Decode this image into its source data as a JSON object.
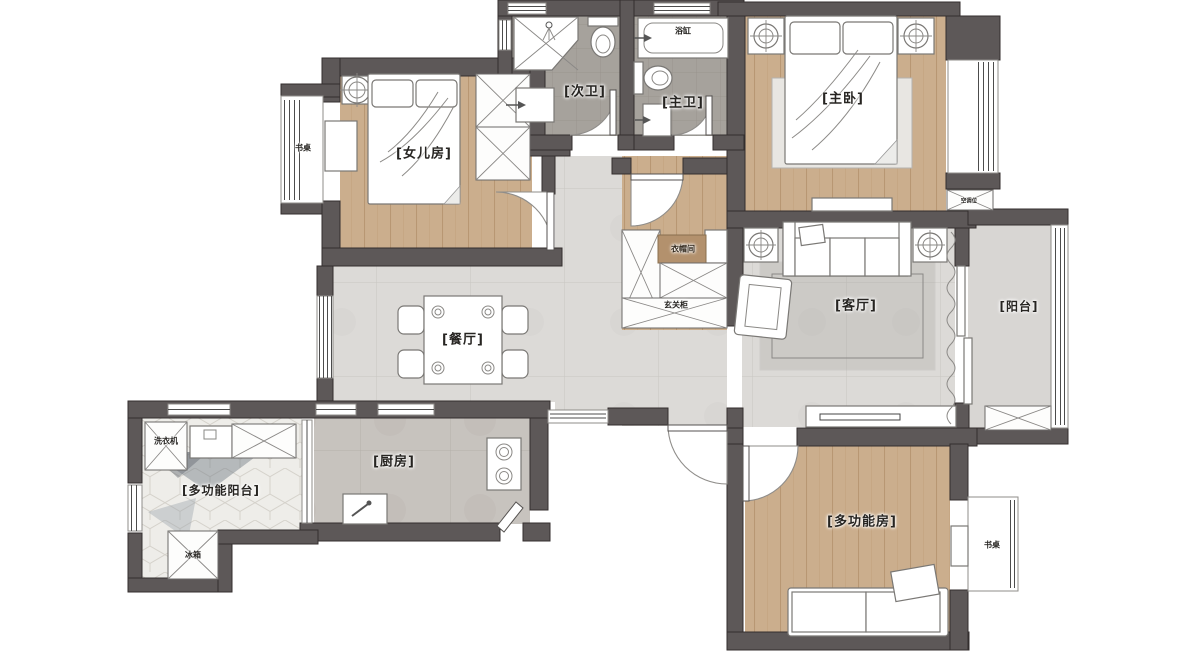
{
  "title": "户型平面图",
  "labels": {
    "daughter_room": "[女儿房]",
    "secondary_bath": "[次卫]",
    "master_bath": "[主卫]",
    "master_bedroom": "[主卧]",
    "dining_room": "[餐厅]",
    "living_room": "[客厅]",
    "balcony": "[阳台]",
    "kitchen": "[厨房]",
    "multi_balcony": "[多功能阳台]",
    "multi_room": "[多功能房]",
    "desk_left": "书桌",
    "desk_right": "书桌",
    "bathtub": "浴缸",
    "cloakroom": "衣帽间",
    "entry_cabinet": "玄关柜",
    "washer": "洗衣机",
    "fridge": "冰箱",
    "ac_unit": "空调位"
  },
  "colors": {
    "wall": "#5d5858",
    "wood": "#cbae8d",
    "tile": "#dcdad7",
    "bath_floor": "#a6a29c",
    "balcony_tile": "#d8d6d3",
    "hex_tile": "#eeede9"
  }
}
